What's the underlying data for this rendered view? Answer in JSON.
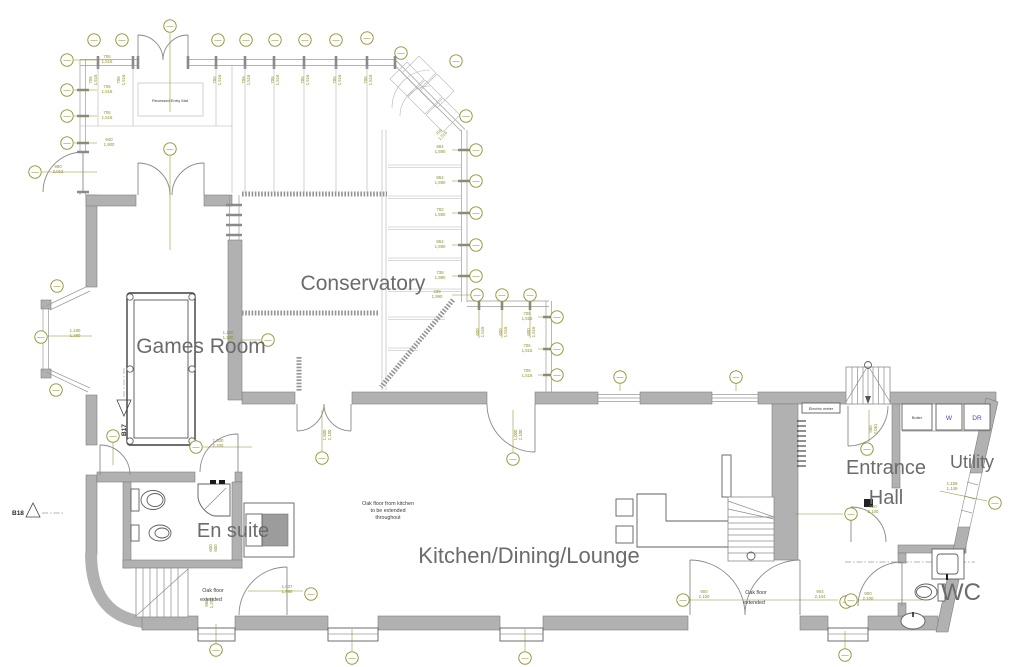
{
  "rooms": {
    "conservatory": "Conservatory",
    "games_room": "Games Room",
    "en_suite": "En suite",
    "kitchen": "Kitchen/Dining/Lounge",
    "entrance_line1": "Entrance",
    "entrance_line2": "Hall",
    "utility": "Utility",
    "wc": "WC"
  },
  "notes": {
    "recessed_entry_mat": "Recessed Entry Mat",
    "oak_floor_note_line1": "Oak floor from kitchen",
    "oak_floor_note_line2": "to be extended",
    "oak_floor_note_line3": "throughout",
    "oak_floor_extended_left_line1": "Oak floor",
    "oak_floor_extended_left_line2": "extended",
    "oak_floor_extended_right_line1": "Oak floor",
    "oak_floor_extended_right_line2": "extended",
    "electric_meter": "Electric meter",
    "boiler": "Boiler",
    "washer": "W",
    "dryer": "DR"
  },
  "section_markers": {
    "b17": "B17",
    "b18": "B18"
  },
  "dims": [
    {
      "a": "706",
      "b": "1,516"
    },
    {
      "a": "706",
      "b": "1,516"
    },
    {
      "a": "706",
      "b": "1,516"
    },
    {
      "a": "940",
      "b": "1,900"
    },
    {
      "a": "980",
      "b": "2,012"
    },
    {
      "a": "706",
      "b": "1,516"
    },
    {
      "a": "706",
      "b": "1,516"
    },
    {
      "a": "706",
      "b": "1,516"
    },
    {
      "a": "706",
      "b": "1,516"
    },
    {
      "a": "706",
      "b": "1,516"
    },
    {
      "a": "706",
      "b": "1,516"
    },
    {
      "a": "706",
      "b": "1,516"
    },
    {
      "a": "706",
      "b": "1,516"
    },
    {
      "a": "706",
      "b": "1,516"
    },
    {
      "a": "884",
      "b": "1,590"
    },
    {
      "a": "864",
      "b": "1,590"
    },
    {
      "a": "782",
      "b": "1,590"
    },
    {
      "a": "864",
      "b": "1,590"
    },
    {
      "a": "738",
      "b": "1,990"
    },
    {
      "a": "438",
      "b": "1,990"
    },
    {
      "a": "600",
      "b": "1,516"
    },
    {
      "a": "600",
      "b": "1,516"
    },
    {
      "a": "600",
      "b": "1,516"
    },
    {
      "a": "706",
      "b": "1,516"
    },
    {
      "a": "706",
      "b": "1,516"
    },
    {
      "a": "706",
      "b": "1,516"
    },
    {
      "a": "1,180",
      "b": "1,280"
    },
    {
      "a": "1,180",
      "b": "1,280"
    },
    {
      "a": "1,300",
      "b": "2,100"
    },
    {
      "a": "600",
      "b": "600"
    },
    {
      "a": "1,037",
      "b": "1,990"
    },
    {
      "a": "860",
      "b": "1,280"
    },
    {
      "a": "900",
      "b": "2,100"
    },
    {
      "a": "904",
      "b": "2,104"
    },
    {
      "a": "960",
      "b": "2,061"
    },
    {
      "a": "900",
      "b": "2,100"
    },
    {
      "a": "900",
      "b": "2,100"
    },
    {
      "a": "1,159",
      "b": "1,149"
    },
    {
      "a": "1,500",
      "b": "2,100"
    },
    {
      "a": "1,000",
      "b": "2,100"
    }
  ],
  "colors": {
    "annotation": "#8f8f2e",
    "wall": "#b1b1b1",
    "label": "#6b6b6b",
    "appliance": "#4444cc"
  }
}
